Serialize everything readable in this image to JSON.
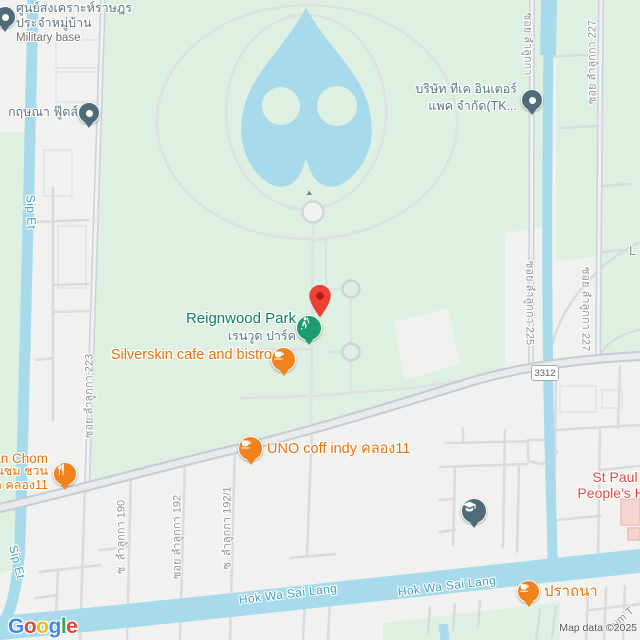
{
  "colors": {
    "park_green": "#ddf0e1",
    "pale_green": "#def0e2",
    "water_blue": "#a7dbec",
    "urban_bg": "#f1f1ef",
    "poi_orange": "#e8710a",
    "poi_pin_orange": "#f0831e",
    "poi_pin_slate": "#4e6b78",
    "poi_pin_green": "#1a9c6e",
    "destination_pin_red": "#ea4335",
    "hospital_red": "#dd4b3e",
    "park_label_teal": "#0e7c62",
    "poi_label_gray": "#5d757e",
    "road_label_gray": "#8f9094",
    "water_label_blue": "#3f9dbe"
  },
  "attribution": {
    "map_data": "Map data ©2025",
    "logo_letters": [
      "G",
      "o",
      "o",
      "g",
      "l",
      "e"
    ]
  },
  "road_shield": "3312",
  "icons": {
    "roundabout_arrow": "➤"
  },
  "pois": {
    "military_base": {
      "line1": "ศูนย์สงเคราะห์ราษฎร",
      "line2": "ประจำหมู่บ้าน",
      "subtitle": "Military base"
    },
    "krisana_foods": {
      "name": "กฤษณา ฟู๊ดส์"
    },
    "tk_interpack": {
      "line1": "บริษัท ทีเค อินเตอร์",
      "line2": "แพค จำกัด(TK..."
    },
    "reignwood_park": {
      "name": "Reignwood Park",
      "name_th": "เรนวูด ปาร์ค"
    },
    "silverskin": {
      "name": "Silverskin cafe and bistro"
    },
    "uno_coffee": {
      "name": "UNO coff indy คลอง11"
    },
    "suan_chom": {
      "line1": "an Chom",
      "line2": "วนชม ชวน",
      "line3": "า คลอง11"
    },
    "st_paul": {
      "line1": "St Paul",
      "line2": "People's Ho"
    },
    "pratthana": {
      "name": "ปราถนา"
    }
  },
  "road_labels": {
    "lam_luk_ka_223": "ซอย ลำลูกกา 223",
    "lam_luk_ka_190": "ซ. ลำลูกกา 190",
    "lam_luk_ka_192": "ซอย ลำลูกกา 192",
    "lam_luk_ka_192_1": "ซ. ลำลูกกา 192/1",
    "lam_luk_ka_225": "ซอย ลำลูกกา 225",
    "lam_luk_ka_partial": "ซอย ลำลูกกา",
    "lam_luk_ka_227": "ซอย ลำลูกกา 227",
    "fragment_right_edge": "L",
    "fragment_bottom_right": "hum T"
  },
  "water_labels": {
    "sip_et": "Sip Et",
    "hok_wa_sai_lang": "Hok Wa Sai Lang"
  }
}
